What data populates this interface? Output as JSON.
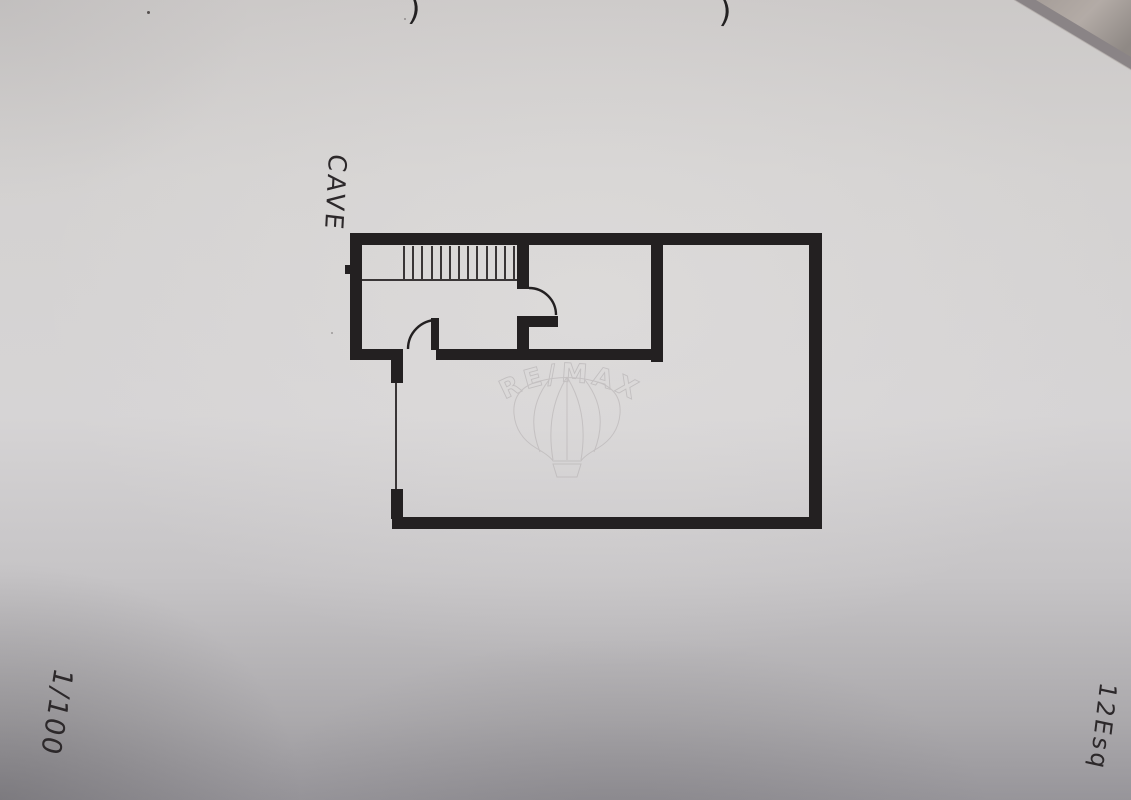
{
  "document": {
    "kind": "scanned-basement-floor-plan-photo",
    "annotations": {
      "room_label": "CAVE",
      "scale_label": "1/100",
      "sheet_label": "12Esq",
      "pen_mark_left": ")",
      "pen_mark_right": ")"
    }
  },
  "watermark": {
    "brand_text": "RE/MAX",
    "icon": "hot-air-balloon-icon",
    "color": "#b2aeaf"
  },
  "colors": {
    "paper": "#d4d2d3",
    "wall_ink": "#232021",
    "thin_ink": "#393536",
    "pen_ink": "#2c282a",
    "desk_corner_dark": "#8a8486",
    "desk_corner_light": "#b3aba6"
  },
  "plan": {
    "wall_thickness": 12,
    "walls": [
      {
        "name": "outer-top-wall",
        "x": 352,
        "y": 233,
        "w": 470,
        "h": 12
      },
      {
        "name": "outer-left-wall",
        "x": 350,
        "y": 233,
        "w": 12,
        "h": 127
      },
      {
        "name": "outer-right-wall",
        "x": 809,
        "y": 233,
        "w": 13,
        "h": 296
      },
      {
        "name": "outer-bottom-wall",
        "x": 392,
        "y": 517,
        "w": 430,
        "h": 12
      },
      {
        "name": "interior-wall-left-segment",
        "x": 350,
        "y": 349,
        "w": 53,
        "h": 11
      },
      {
        "name": "interior-wall-right-segment",
        "x": 436,
        "y": 349,
        "w": 227,
        "h": 11
      },
      {
        "name": "room-divider-wall",
        "x": 651,
        "y": 240,
        "w": 12,
        "h": 122
      },
      {
        "name": "stair-side-wall",
        "x": 517,
        "y": 245,
        "w": 12,
        "h": 44
      },
      {
        "name": "door-jamb-stub",
        "x": 517,
        "y": 316,
        "w": 41,
        "h": 11
      },
      {
        "name": "door-jamb-lower",
        "x": 517,
        "y": 327,
        "w": 12,
        "h": 24
      },
      {
        "name": "lower-door-leaf",
        "x": 431,
        "y": 318,
        "w": 8,
        "h": 32
      },
      {
        "name": "left-opening-stub-top",
        "x": 391,
        "y": 358,
        "w": 12,
        "h": 25
      },
      {
        "name": "left-opening-stub-bottom",
        "x": 391,
        "y": 489,
        "w": 12,
        "h": 30
      },
      {
        "name": "left-wall-nub",
        "x": 345,
        "y": 265,
        "w": 7,
        "h": 9
      }
    ],
    "thin_lines": [
      {
        "name": "stair-bottom-line",
        "x1": 362,
        "y1": 280,
        "x2": 517,
        "y2": 280
      },
      {
        "name": "left-wall-opening-line",
        "x1": 396,
        "y1": 383,
        "x2": 396,
        "y2": 489
      }
    ],
    "door_arcs": [
      {
        "name": "upper-door-swing-arc",
        "d": "M 529 288 A 27 27 0 0 1 556 315"
      },
      {
        "name": "lower-door-swing-arc",
        "d": "M 437 320 A 29 29 0 0 0 408 349"
      }
    ],
    "stairs": {
      "x_start": 404,
      "x_end": 514,
      "y_top": 246,
      "y_bottom": 280,
      "step_count": 13
    }
  }
}
